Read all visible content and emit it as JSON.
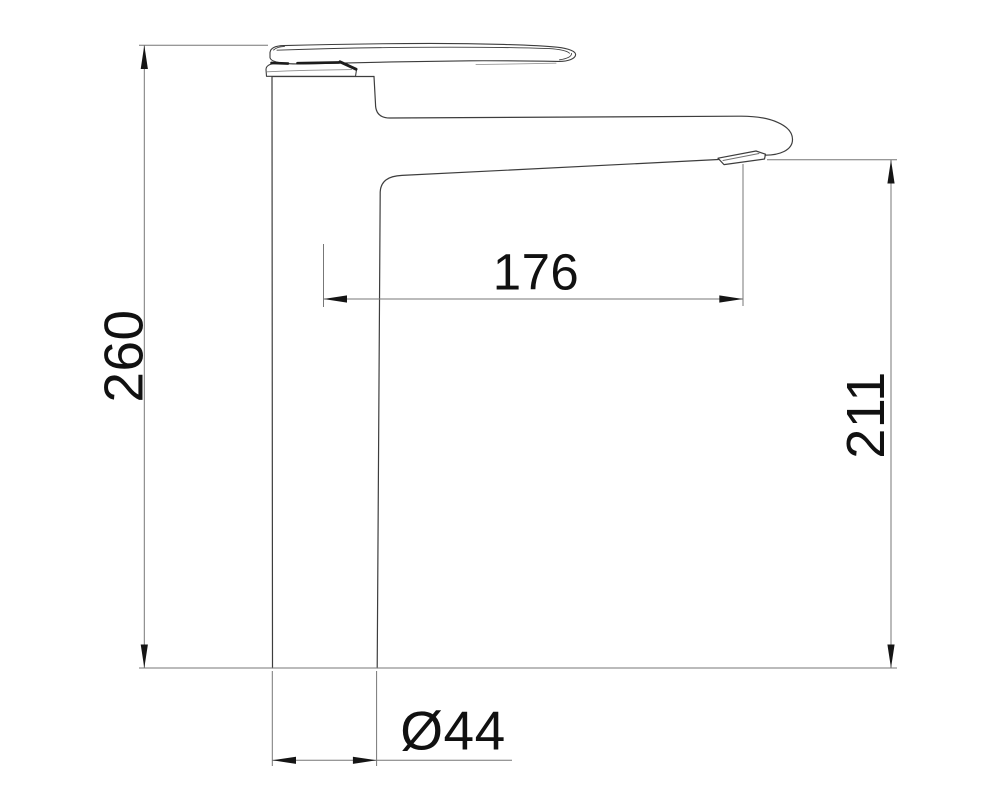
{
  "drawing": {
    "type": "technical-dimension-drawing",
    "subject": "tall single-lever basin mixer tap, side view",
    "background_color": "#ffffff",
    "outline_color": "#3d3d3d",
    "dimension_line_color": "#777777",
    "arrow_color": "#151515",
    "text_color": "#111111",
    "dimensions": {
      "overall_height": {
        "label": "260",
        "value": 260,
        "orientation": "vertical",
        "position": "left"
      },
      "spout_reach": {
        "label": "176",
        "value": 176,
        "orientation": "horizontal",
        "position": "middle"
      },
      "spout_height": {
        "label": "211",
        "value": 211,
        "orientation": "vertical",
        "position": "right"
      },
      "base_diameter": {
        "label": "Ø44",
        "value": 44,
        "orientation": "horizontal",
        "position": "bottom"
      }
    }
  }
}
